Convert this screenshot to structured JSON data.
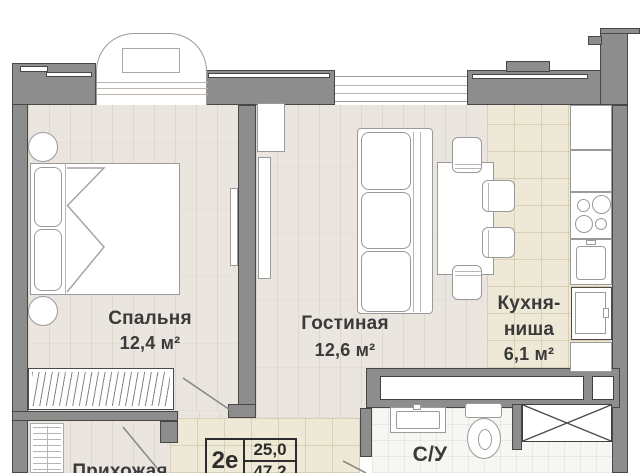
{
  "plan": {
    "title": "apartment-floor-plan",
    "rooms": {
      "bedroom": {
        "name": "Спальня",
        "area": "12,4 м²"
      },
      "living": {
        "name": "Гостиная",
        "area": "12,6 м²"
      },
      "kitchen": {
        "name_line1": "Кухня-",
        "name_line2": "ниша",
        "area": "6,1 м²"
      },
      "bathroom": {
        "name": "С/У"
      },
      "hallway": {
        "name": "Прихожая"
      }
    },
    "stamp": {
      "unit_type": "2е",
      "living_area": "25,0",
      "total_area": "47,2"
    },
    "colors": {
      "wall_fill": "#8d8d8d",
      "wall_line": "#474747",
      "wood_floor": "#eae5de",
      "kitchen_tile": "#eee8d6",
      "bath_tile": "#f7f6f2",
      "label_text": "#3a3a3a"
    }
  }
}
